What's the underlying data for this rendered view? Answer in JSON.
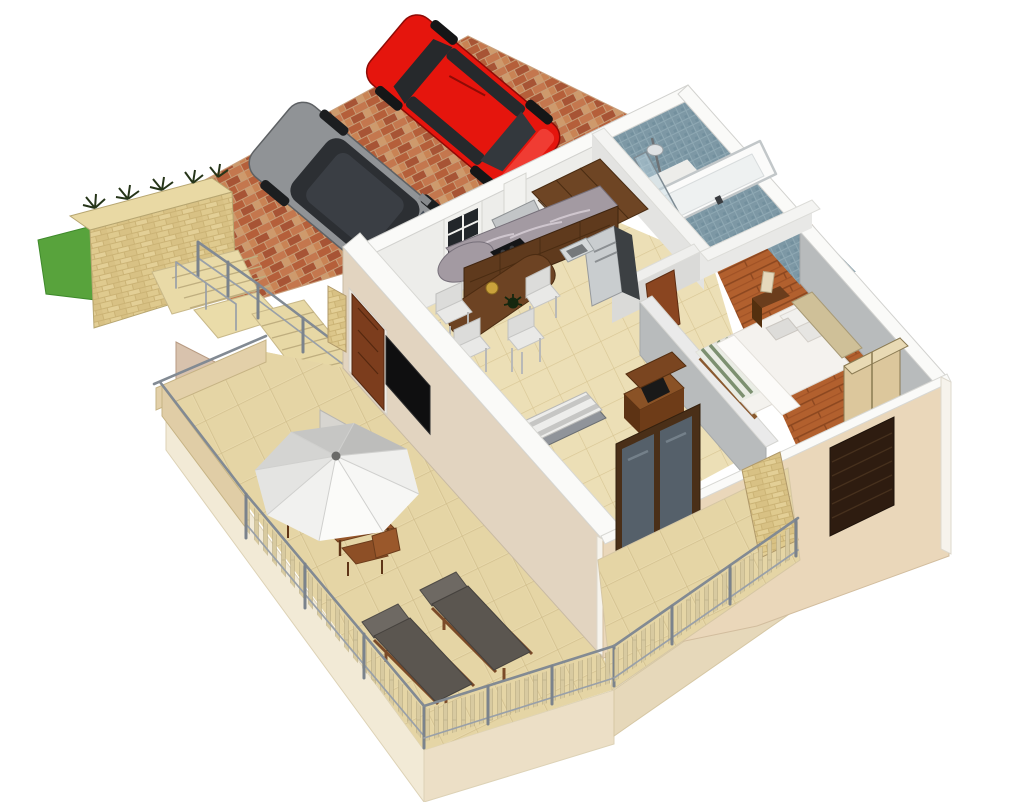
{
  "scene": {
    "description": "3D isometric architectural rendering (SketchUp style) of a one-bedroom house with roof terrace, front balcony and brick driveway with two parked cars",
    "outdoor": {
      "driveway_label": "Brick paved driveway",
      "vehicles": [
        {
          "label": "Red hatchback car"
        },
        {
          "label": "Grey car"
        }
      ],
      "garden_wall_label": "Sandstone garden wall with plants",
      "lawn_label": "Grass patch",
      "stairs_label": "Stone staircase with metal railings"
    },
    "rooms": [
      {
        "id": "kitchen",
        "label": "Kitchen and dining area",
        "features": [
          "dark wood cabinets",
          "granite countertop",
          "cooker hood",
          "cooktop",
          "fridge",
          "sink",
          "dining table",
          "four white stools",
          "window"
        ]
      },
      {
        "id": "bathroom",
        "label": "Bathroom",
        "features": [
          "blue mosaic tiling",
          "bathtub",
          "curved glass shower screen",
          "shower column"
        ]
      },
      {
        "id": "hallway",
        "label": "Hallway",
        "features": [
          "wooden interior door"
        ]
      },
      {
        "id": "bedroom",
        "label": "Bedroom",
        "features": [
          "double bed",
          "white duvet",
          "striped throw",
          "pillows",
          "headboard",
          "nightstand with lamp",
          "wardrobe",
          "dresser",
          "timber floor"
        ]
      },
      {
        "id": "living",
        "label": "Living area",
        "features": [
          "striped daybed",
          "wooden media cabinet",
          "wall mounted TV",
          "sliding glass door"
        ]
      }
    ],
    "terrace_label": "Tiled roof terrace",
    "terrace_features": [
      "white parasol",
      "wooden table",
      "wooden chairs",
      "two sun loungers",
      "baluster railing",
      "parapet wall"
    ],
    "balcony_label": "Front balcony",
    "balcony_features": [
      "baluster railing",
      "stone pier",
      "louvred shutter window"
    ]
  },
  "colors": {
    "background": "#ffffff",
    "car_red": "#e5150d",
    "car_gray": "#909396",
    "wall_white": "#fafaf8",
    "wall_beige_sw": "#e2d4c0",
    "wall_beige_se": "#ead7ba",
    "wall_gray": "#b8bbbc",
    "tv_black": "#0f0f10",
    "tub_white": "#fbfbfa",
    "bed_white": "#f4f2ee",
    "lounger_cushion": "#5b5650",
    "door_brown": "#7c3d1d",
    "glass_blue": "#55606a",
    "umbrella_white": "#f7f7f5",
    "umbrella_gray": "#c6c6c4",
    "railing_metal": "#828a93",
    "brick": "#b5623c",
    "stone": "#dbc584",
    "grass": "#58a33c",
    "terrace_tile": "#e8d9ac",
    "bathroom_blue": "#7d98a5",
    "wood_floor": "#b2602e",
    "kitchen_wood": "#6e4524"
  }
}
